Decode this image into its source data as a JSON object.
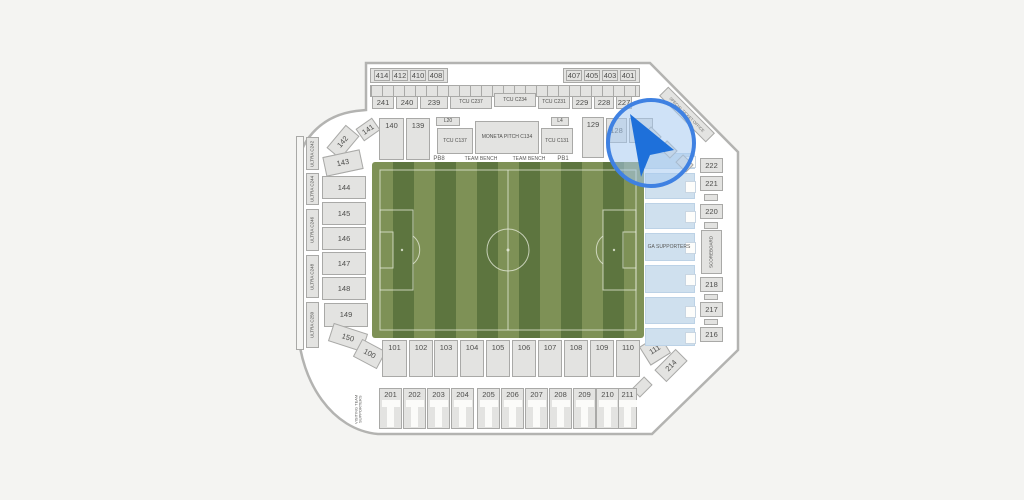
{
  "map": {
    "venue_type": "soccer-stadium-seating-chart",
    "colors": {
      "background": "#f4f4f2",
      "shell_fill": "#ffffff",
      "shell_stroke": "#b3b3b1",
      "section_fill": "#e3e3e1",
      "section_stroke": "#a9a9a7",
      "label_text": "#4e4e4c",
      "field_light": "#7e9156",
      "field_dark": "#5d753f",
      "field_line": "#e9eedf",
      "ga_fill": "#cfe0ee",
      "cursor_ring": "#3f81e2",
      "cursor_lens": "rgba(168,203,240,0.55)",
      "cursor_arrow": "#1e70da"
    },
    "cursor": {
      "icon": "navigation-arrow-icon",
      "x": 651,
      "y": 143
    }
  },
  "sections": [
    {
      "n": "suite-box-left",
      "l": "",
      "x": 370,
      "y": 68,
      "w": 78,
      "h": 15,
      "i": 0
    },
    {
      "n": "suite-box-right",
      "l": "",
      "x": 563,
      "y": 68,
      "w": 77,
      "h": 15,
      "i": 0
    },
    {
      "l": "414",
      "x": 374,
      "y": 70,
      "w": 16,
      "h": 11
    },
    {
      "l": "412",
      "x": 392,
      "y": 70,
      "w": 16,
      "h": 11
    },
    {
      "l": "410",
      "x": 410,
      "y": 70,
      "w": 16,
      "h": 11
    },
    {
      "l": "408",
      "x": 428,
      "y": 70,
      "w": 16,
      "h": 11
    },
    {
      "l": "407",
      "x": 566,
      "y": 70,
      "w": 16,
      "h": 11
    },
    {
      "l": "405",
      "x": 584,
      "y": 70,
      "w": 16,
      "h": 11
    },
    {
      "l": "403",
      "x": 602,
      "y": 70,
      "w": 16,
      "h": 11
    },
    {
      "l": "401",
      "x": 620,
      "y": 70,
      "w": 16,
      "h": 11
    },
    {
      "n": "suite-strip",
      "l": "",
      "x": 370,
      "y": 85,
      "w": 270,
      "h": 12,
      "c": "strip",
      "i": 0
    },
    {
      "l": "241",
      "x": 372,
      "y": 96,
      "w": 22,
      "h": 13
    },
    {
      "l": "240",
      "x": 396,
      "y": 96,
      "w": 22,
      "h": 13
    },
    {
      "l": "239",
      "x": 420,
      "y": 96,
      "w": 28,
      "h": 13
    },
    {
      "l": "TCU C237",
      "x": 450,
      "y": 96,
      "w": 42,
      "h": 13,
      "f": 5
    },
    {
      "l": "TCU C234",
      "x": 494,
      "y": 93,
      "w": 42,
      "h": 14,
      "f": 5
    },
    {
      "l": "TCU C231",
      "x": 538,
      "y": 96,
      "w": 32,
      "h": 13,
      "f": 5
    },
    {
      "l": "229",
      "x": 572,
      "y": 96,
      "w": 20,
      "h": 13
    },
    {
      "l": "228",
      "x": 594,
      "y": 96,
      "w": 20,
      "h": 13
    },
    {
      "l": "227",
      "x": 616,
      "y": 96,
      "w": 16,
      "h": 13
    },
    {
      "l": "141",
      "x": 358,
      "y": 122,
      "w": 20,
      "h": 15,
      "r": -35
    },
    {
      "l": "140",
      "x": 379,
      "y": 118,
      "w": 25,
      "h": 42,
      "c": "top"
    },
    {
      "l": "139",
      "x": 406,
      "y": 118,
      "w": 24,
      "h": 42,
      "c": "top"
    },
    {
      "l": "L20",
      "x": 436,
      "y": 117,
      "w": 24,
      "h": 9,
      "f": 5
    },
    {
      "l": "TCU C137",
      "x": 437,
      "y": 128,
      "w": 36,
      "h": 26,
      "f": 5
    },
    {
      "l": "MONETA PITCH C134",
      "x": 475,
      "y": 121,
      "w": 64,
      "h": 33,
      "f": 5
    },
    {
      "l": "TCU C131",
      "x": 541,
      "y": 128,
      "w": 32,
      "h": 26,
      "f": 5
    },
    {
      "l": "L4",
      "x": 551,
      "y": 117,
      "w": 18,
      "h": 9,
      "f": 5
    },
    {
      "l": "129",
      "x": 582,
      "y": 117,
      "w": 22,
      "h": 41,
      "c": "top"
    },
    {
      "l": "128",
      "x": 606,
      "y": 118,
      "w": 21,
      "h": 25
    },
    {
      "l": "127",
      "x": 629,
      "y": 118,
      "w": 24,
      "h": 25
    },
    {
      "l": "PB8",
      "x": 430,
      "y": 154,
      "w": 18,
      "h": 9,
      "c": "txt",
      "f": 6
    },
    {
      "n": "team-bench-left",
      "l": "TEAM BENCH",
      "x": 458,
      "y": 156,
      "w": 46,
      "h": 7,
      "c": "txt",
      "f": 5,
      "i": 0
    },
    {
      "n": "team-bench-right",
      "l": "TEAM BENCH",
      "x": 506,
      "y": 156,
      "w": 46,
      "h": 7,
      "c": "txt",
      "f": 5,
      "i": 0
    },
    {
      "l": "PB1",
      "x": 554,
      "y": 154,
      "w": 18,
      "h": 9,
      "c": "txt",
      "f": 6
    },
    {
      "n": "west-rail",
      "l": "",
      "x": 296,
      "y": 136,
      "w": 8,
      "h": 214,
      "c": "rail",
      "i": 0
    },
    {
      "l": "ULTRA C242",
      "x": 306,
      "y": 137,
      "w": 13,
      "h": 33,
      "c": "vert",
      "f": 4.5
    },
    {
      "l": "ULTRA C244",
      "x": 306,
      "y": 173,
      "w": 13,
      "h": 32,
      "c": "vert",
      "f": 4.5
    },
    {
      "l": "ULTRA C246",
      "x": 306,
      "y": 209,
      "w": 13,
      "h": 42,
      "c": "vert",
      "f": 4.5
    },
    {
      "l": "ULTRA C248",
      "x": 306,
      "y": 255,
      "w": 13,
      "h": 43,
      "c": "vert",
      "f": 4.5
    },
    {
      "l": "ULTRA C250",
      "x": 306,
      "y": 302,
      "w": 13,
      "h": 46,
      "c": "vert",
      "f": 4.5
    },
    {
      "l": "142",
      "x": 328,
      "y": 133,
      "w": 30,
      "h": 18,
      "r": -50
    },
    {
      "l": "143",
      "x": 324,
      "y": 153,
      "w": 38,
      "h": 20,
      "r": -12
    },
    {
      "l": "144",
      "x": 322,
      "y": 176,
      "w": 44,
      "h": 23
    },
    {
      "l": "145",
      "x": 322,
      "y": 202,
      "w": 44,
      "h": 23
    },
    {
      "l": "146",
      "x": 322,
      "y": 227,
      "w": 44,
      "h": 23
    },
    {
      "l": "147",
      "x": 322,
      "y": 252,
      "w": 44,
      "h": 23
    },
    {
      "l": "148",
      "x": 322,
      "y": 277,
      "w": 44,
      "h": 23
    },
    {
      "l": "149",
      "x": 324,
      "y": 303,
      "w": 44,
      "h": 24
    },
    {
      "l": "150",
      "x": 330,
      "y": 328,
      "w": 36,
      "h": 19,
      "r": 18
    },
    {
      "l": "100",
      "x": 356,
      "y": 344,
      "w": 27,
      "h": 20,
      "r": 28
    },
    {
      "l": "101",
      "x": 382,
      "y": 340,
      "w": 25,
      "h": 37,
      "c": "top"
    },
    {
      "l": "102",
      "x": 409,
      "y": 340,
      "w": 24,
      "h": 37,
      "c": "top"
    },
    {
      "l": "103",
      "x": 434,
      "y": 340,
      "w": 24,
      "h": 37,
      "c": "top"
    },
    {
      "l": "104",
      "x": 460,
      "y": 340,
      "w": 24,
      "h": 37,
      "c": "top"
    },
    {
      "l": "105",
      "x": 486,
      "y": 340,
      "w": 24,
      "h": 37,
      "c": "top"
    },
    {
      "l": "106",
      "x": 512,
      "y": 340,
      "w": 24,
      "h": 37,
      "c": "top"
    },
    {
      "l": "107",
      "x": 538,
      "y": 340,
      "w": 24,
      "h": 37,
      "c": "top"
    },
    {
      "l": "108",
      "x": 564,
      "y": 340,
      "w": 24,
      "h": 37,
      "c": "top"
    },
    {
      "l": "109",
      "x": 590,
      "y": 340,
      "w": 24,
      "h": 37,
      "c": "top"
    },
    {
      "l": "110",
      "x": 616,
      "y": 340,
      "w": 24,
      "h": 37,
      "c": "top"
    },
    {
      "l": "111",
      "x": 643,
      "y": 339,
      "w": 24,
      "h": 22,
      "r": -32
    },
    {
      "l": "214",
      "x": 656,
      "y": 357,
      "w": 30,
      "h": 17,
      "r": -45
    },
    {
      "n": "deco-corner-1",
      "l": "",
      "x": 633,
      "y": 381,
      "w": 18,
      "h": 12,
      "r": -45,
      "i": 0
    },
    {
      "n": "deco-corner-2",
      "l": "",
      "x": 613,
      "y": 399,
      "w": 16,
      "h": 11,
      "r": -45,
      "i": 0
    },
    {
      "l": "201",
      "x": 379,
      "y": 388,
      "w": 23,
      "h": 41,
      "c": "cut"
    },
    {
      "l": "202",
      "x": 403,
      "y": 388,
      "w": 23,
      "h": 41,
      "c": "cut"
    },
    {
      "l": "203",
      "x": 427,
      "y": 388,
      "w": 23,
      "h": 41,
      "c": "cut"
    },
    {
      "l": "204",
      "x": 451,
      "y": 388,
      "w": 23,
      "h": 41,
      "c": "cut"
    },
    {
      "l": "205",
      "x": 477,
      "y": 388,
      "w": 23,
      "h": 41,
      "c": "cut"
    },
    {
      "l": "206",
      "x": 501,
      "y": 388,
      "w": 23,
      "h": 41,
      "c": "cut"
    },
    {
      "l": "207",
      "x": 525,
      "y": 388,
      "w": 23,
      "h": 41,
      "c": "cut"
    },
    {
      "l": "208",
      "x": 549,
      "y": 388,
      "w": 23,
      "h": 41,
      "c": "cut"
    },
    {
      "l": "209",
      "x": 573,
      "y": 388,
      "w": 23,
      "h": 41,
      "c": "cut"
    },
    {
      "l": "210",
      "x": 596,
      "y": 388,
      "w": 23,
      "h": 41,
      "c": "cut"
    },
    {
      "l": "211",
      "x": 618,
      "y": 388,
      "w": 19,
      "h": 41,
      "c": "cut"
    },
    {
      "n": "visiting-team-supporters-label",
      "l": "VISITING TEAM SUPPORTERS",
      "x": 350,
      "y": 386,
      "w": 17,
      "h": 46,
      "c": "vert txt",
      "f": 4,
      "i": 0
    },
    {
      "n": "ga-band-1",
      "l": "",
      "x": 645,
      "y": 153,
      "w": 50,
      "h": 16,
      "c": "ga"
    },
    {
      "n": "ga-band-2",
      "l": "",
      "x": 645,
      "y": 173,
      "w": 50,
      "h": 26,
      "c": "ga"
    },
    {
      "n": "ga-band-3",
      "l": "",
      "x": 645,
      "y": 203,
      "w": 50,
      "h": 26,
      "c": "ga"
    },
    {
      "n": "ga-band-4",
      "l": "",
      "x": 645,
      "y": 233,
      "w": 50,
      "h": 28,
      "c": "ga"
    },
    {
      "n": "ga-band-5",
      "l": "",
      "x": 645,
      "y": 265,
      "w": 50,
      "h": 28,
      "c": "ga"
    },
    {
      "n": "ga-band-6",
      "l": "",
      "x": 645,
      "y": 297,
      "w": 50,
      "h": 27,
      "c": "ga"
    },
    {
      "n": "ga-band-7",
      "l": "",
      "x": 645,
      "y": 328,
      "w": 50,
      "h": 18,
      "c": "ga"
    },
    {
      "n": "ga-supporters-label",
      "l": "GA SUPPORTERS",
      "x": 641,
      "y": 243,
      "w": 56,
      "h": 9,
      "c": "txt",
      "f": 5,
      "i": 0
    },
    {
      "l": "222",
      "x": 700,
      "y": 158,
      "w": 23,
      "h": 15
    },
    {
      "l": "221",
      "x": 700,
      "y": 176,
      "w": 23,
      "h": 15
    },
    {
      "n": "deco-east-1",
      "l": "",
      "x": 704,
      "y": 194,
      "w": 14,
      "h": 7,
      "i": 0
    },
    {
      "l": "220",
      "x": 700,
      "y": 204,
      "w": 23,
      "h": 15
    },
    {
      "n": "deco-east-2",
      "l": "",
      "x": 704,
      "y": 222,
      "w": 14,
      "h": 7,
      "i": 0
    },
    {
      "l": "SCOREBOARD",
      "x": 701,
      "y": 230,
      "w": 21,
      "h": 44,
      "c": "vert",
      "f": 4.5,
      "i": 0
    },
    {
      "l": "218",
      "x": 700,
      "y": 277,
      "w": 23,
      "h": 15
    },
    {
      "n": "deco-east-3",
      "l": "",
      "x": 704,
      "y": 294,
      "w": 14,
      "h": 6,
      "i": 0
    },
    {
      "l": "217",
      "x": 700,
      "y": 302,
      "w": 23,
      "h": 15
    },
    {
      "n": "deco-east-4",
      "l": "",
      "x": 704,
      "y": 319,
      "w": 14,
      "h": 6,
      "i": 0
    },
    {
      "l": "216",
      "x": 700,
      "y": 327,
      "w": 23,
      "h": 15
    },
    {
      "n": "special-ticket-office",
      "l": "SPECIAL TICKET OFFICE",
      "x": 654,
      "y": 108,
      "w": 66,
      "h": 13,
      "r": 45,
      "c": "diag",
      "f": 4,
      "i": 0
    },
    {
      "n": "deco-ne-1",
      "l": "",
      "x": 645,
      "y": 130,
      "w": 15,
      "h": 11,
      "r": 45,
      "i": 0
    },
    {
      "n": "deco-ne-2",
      "l": "",
      "x": 661,
      "y": 144,
      "w": 15,
      "h": 11,
      "r": 45,
      "i": 0
    },
    {
      "n": "deco-ne-3",
      "l": "",
      "x": 677,
      "y": 158,
      "w": 15,
      "h": 11,
      "r": 45,
      "i": 0
    }
  ]
}
